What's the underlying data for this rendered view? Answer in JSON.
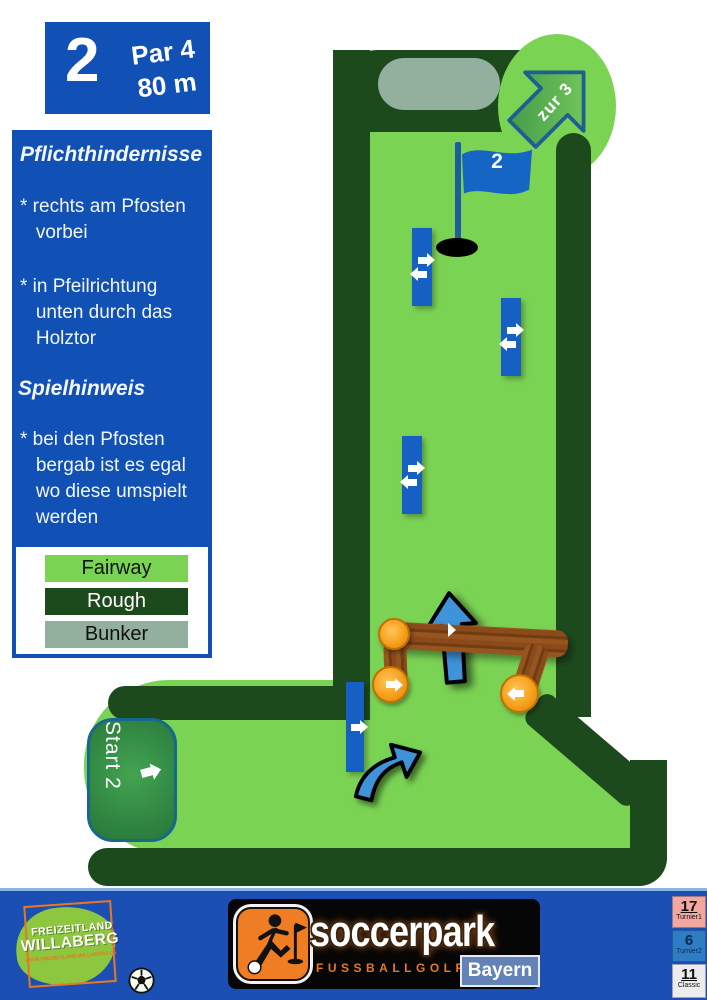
{
  "hole_card": {
    "number": "2",
    "par": "Par 4",
    "distance": "80 m"
  },
  "info_panel": {
    "heading_obstacles": "Pflichthindernisse",
    "rule_post": "* rechts am Pfosten\n   vorbei",
    "rule_gate": "* in Pfeilrichtung\n   unten durch das\n   Holztor",
    "heading_hint": "Spielhinweis",
    "hint_posts": "* bei den Pfosten\n   bergab ist es egal\n   wo diese umspielt\n   werden"
  },
  "legend": {
    "items": [
      {
        "label": "Fairway",
        "color": "#7bd354"
      },
      {
        "label": "Rough",
        "color": "#1d4a1c"
      },
      {
        "label": "Bunker",
        "color": "#93af9e"
      }
    ]
  },
  "course": {
    "flag_label": "2",
    "start_label": "Start 2",
    "next_hole_label": "zur 3",
    "posts": [
      {
        "name": "post-near-hole",
        "arrows": [
          "right",
          "left"
        ]
      },
      {
        "name": "post-upper-right",
        "arrows": [
          "right",
          "left"
        ]
      },
      {
        "name": "post-middle",
        "arrows": [
          "right",
          "left"
        ]
      },
      {
        "name": "post-bottom",
        "arrows": [
          "right"
        ]
      }
    ],
    "gate": {
      "name": "Holztor",
      "arrows": [
        "up",
        "down",
        "right",
        "left"
      ]
    },
    "colors": {
      "fairway": "#7bd354",
      "rough": "#1d4a1c",
      "bunker": "#93af9e",
      "marker_blue": "#1560c2",
      "panel_blue": "#1151b5",
      "wood": "#8a4a1a",
      "log_end_orange": "#f5a01c"
    }
  },
  "icons": {
    "post_arrow_right": "block-arrow-right",
    "post_arrow_left": "block-arrow-left",
    "gate_arrow_down": "block-arrow-down",
    "gate_arrow_up": "big-blue-arrow-up",
    "curved_arrow": "curved-arrow-up-right",
    "next_hole_arrow": "arrow-up-right",
    "flag": "golf-flag",
    "soccer_player": "soccer-player-kicking",
    "soccer_ball": "soccer-ball"
  },
  "footer": {
    "park_logo": {
      "line1": "FREIZEITLAND",
      "line2": "WILLABERG",
      "url": "WWW.FREIZEITLAND-WILLABERG.DE"
    },
    "brand": {
      "name": "soccerpark",
      "subtitle": "FUSSBALLGOLF",
      "region": "Bayern"
    },
    "score_cards": [
      {
        "number": "17",
        "label": "Turnier1",
        "color": "#f0a8a0"
      },
      {
        "number": "6",
        "label": "Turnier2",
        "color": "#2e7cc4"
      },
      {
        "number": "11",
        "label": "Classic",
        "color": "#ececec"
      }
    ]
  }
}
